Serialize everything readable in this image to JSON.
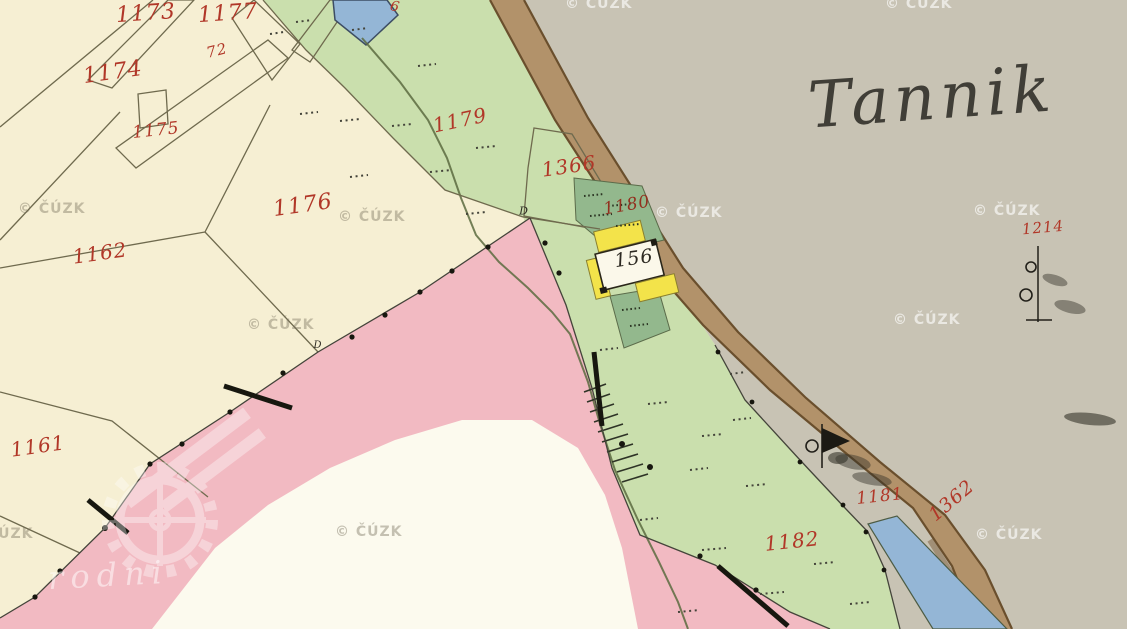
{
  "map": {
    "title": "Tannik",
    "logo_text": "rodni",
    "watermark_text": "© ČÚZK",
    "labels": [
      {
        "text": "1173",
        "x": 146,
        "y": 14,
        "size": 22,
        "rot": -4,
        "color": "red"
      },
      {
        "text": "1177",
        "x": 228,
        "y": 14,
        "size": 22,
        "rot": -4,
        "color": "red"
      },
      {
        "text": "72",
        "x": 217,
        "y": 51,
        "size": 15,
        "rot": -14,
        "color": "red"
      },
      {
        "text": "1174",
        "x": 113,
        "y": 73,
        "size": 22,
        "rot": -8,
        "color": "red"
      },
      {
        "text": "1175",
        "x": 156,
        "y": 131,
        "size": 17,
        "rot": -6,
        "color": "red"
      },
      {
        "text": "1176",
        "x": 303,
        "y": 206,
        "size": 22,
        "rot": -8,
        "color": "red"
      },
      {
        "text": "1162",
        "x": 100,
        "y": 253,
        "size": 20,
        "rot": -8,
        "color": "red"
      },
      {
        "text": "1161",
        "x": 38,
        "y": 446,
        "size": 20,
        "rot": -8,
        "color": "red"
      },
      {
        "text": "1179",
        "x": 460,
        "y": 120,
        "size": 20,
        "rot": -12,
        "color": "red"
      },
      {
        "text": "1366",
        "x": 569,
        "y": 166,
        "size": 20,
        "rot": -8,
        "color": "red"
      },
      {
        "text": "1180",
        "x": 627,
        "y": 206,
        "size": 17,
        "rot": -10,
        "color": "darkred"
      },
      {
        "text": "156",
        "x": 634,
        "y": 259,
        "size": 19,
        "rot": -8,
        "color": "black"
      },
      {
        "text": "1214",
        "x": 1043,
        "y": 228,
        "size": 15,
        "rot": -5,
        "color": "red"
      },
      {
        "text": "1181",
        "x": 880,
        "y": 497,
        "size": 17,
        "rot": -6,
        "color": "red"
      },
      {
        "text": "1362",
        "x": 952,
        "y": 501,
        "size": 19,
        "rot": -40,
        "color": "red"
      },
      {
        "text": "1182",
        "x": 792,
        "y": 541,
        "size": 20,
        "rot": -6,
        "color": "red"
      },
      {
        "text": "D",
        "x": 524,
        "y": 211,
        "size": 11,
        "rot": 0,
        "color": "black"
      },
      {
        "text": "D",
        "x": 318,
        "y": 346,
        "size": 10,
        "rot": 0,
        "color": "black"
      },
      {
        "text": "6",
        "x": 395,
        "y": 7,
        "size": 14,
        "rot": 12,
        "color": "red"
      }
    ],
    "watermarks": [
      {
        "x": 565,
        "y": -4,
        "variant": "light"
      },
      {
        "x": 885,
        "y": -4,
        "variant": "light"
      },
      {
        "x": 655,
        "y": 205,
        "variant": "light"
      },
      {
        "x": 973,
        "y": 203,
        "variant": "light"
      },
      {
        "x": 893,
        "y": 312,
        "variant": "light"
      },
      {
        "x": 975,
        "y": 527,
        "variant": "light"
      },
      {
        "x": 18,
        "y": 201,
        "variant": "dark"
      },
      {
        "x": 338,
        "y": 209,
        "variant": "dark"
      },
      {
        "x": 247,
        "y": 317,
        "variant": "dark"
      },
      {
        "x": 335,
        "y": 524,
        "variant": "dark"
      },
      {
        "x": -34,
        "y": 526,
        "variant": "dark"
      }
    ],
    "colors": {
      "cream": "#f6efd3",
      "white_area": "#fcfaee",
      "green": "#cadfad",
      "garden": "#93b88d",
      "gray": "#c8c3b4",
      "pink": "#f2bac2",
      "road": "#b2926a",
      "road_edge": "#6a4f2d",
      "tan": "#c2a478",
      "blue": "#94b6d6",
      "building_yellow": "#f3e34a",
      "label_red": "#b13728",
      "label_darkred": "#93301f",
      "label_black": "#2c2921",
      "ink": "#403e37",
      "thin_line": "#6f6a4e",
      "boundary": "#44443a",
      "mark": "#17170f"
    }
  }
}
